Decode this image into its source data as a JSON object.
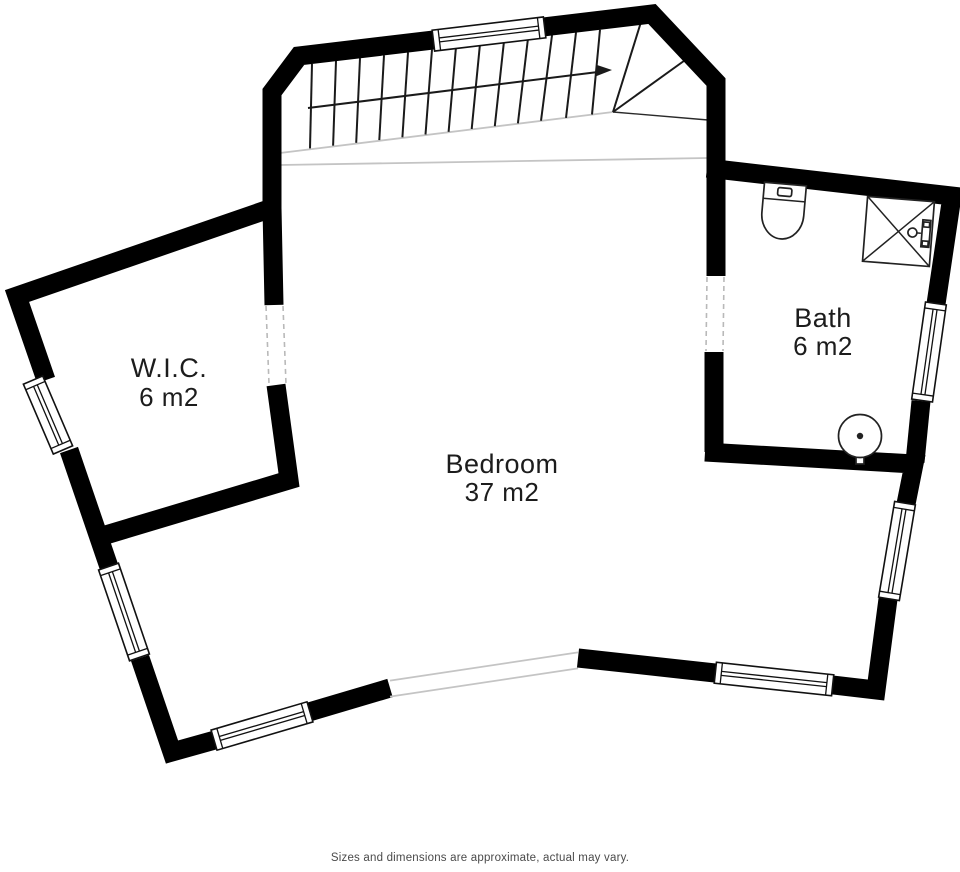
{
  "plan": {
    "title": "Upper floor plan",
    "rooms": [
      {
        "id": "wic",
        "name": "W.I.C.",
        "area": "6 m2"
      },
      {
        "id": "bedroom",
        "name": "Bedroom",
        "area": "37 m2"
      },
      {
        "id": "bath",
        "name": "Bath",
        "area": "6 m2"
      }
    ],
    "disclaimer": "Sizes and dimensions are approximate, actual may vary.",
    "colors": {
      "wall": "#000000",
      "light_line": "#c4c4c4",
      "text": "#1c1c1c",
      "disclaimer_text": "#4a4a4a",
      "background": "#ffffff"
    },
    "fixtures": [
      {
        "icon": "stairs-icon",
        "room": "landing"
      },
      {
        "icon": "toilet-icon",
        "room": "bath"
      },
      {
        "icon": "shower-icon",
        "room": "bath"
      },
      {
        "icon": "sink-icon",
        "room": "bath"
      }
    ]
  }
}
